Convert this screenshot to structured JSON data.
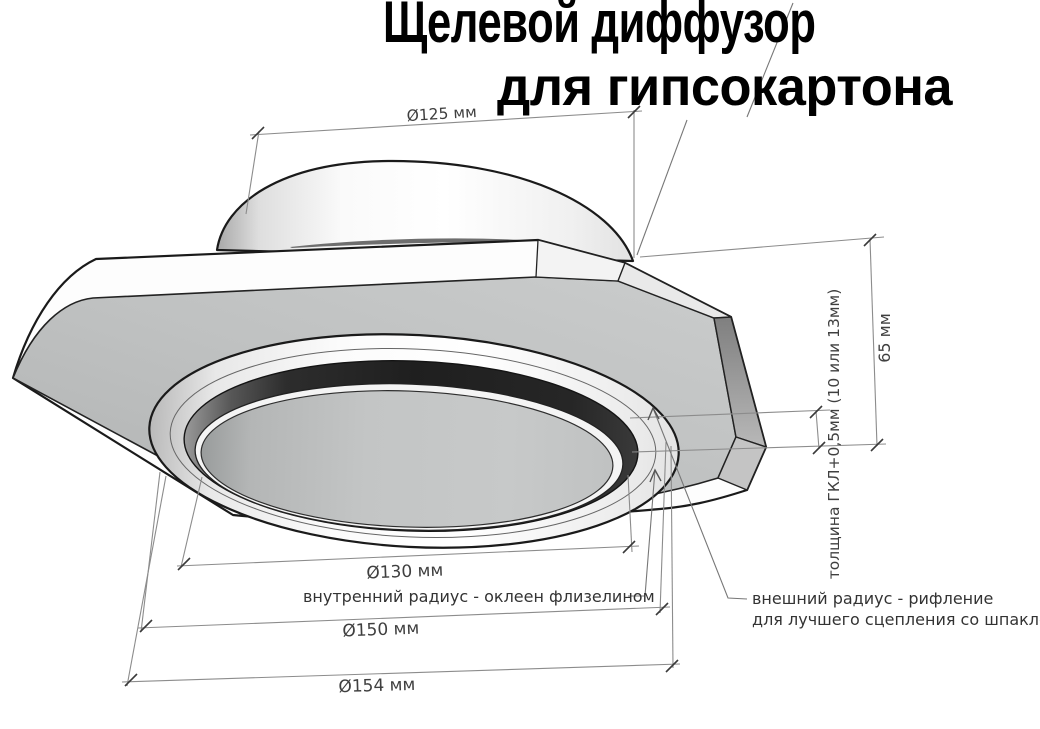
{
  "title": {
    "line1": "Щелевой диффузор",
    "line2": "для гипсокартона"
  },
  "dimensions": {
    "top_diameter": {
      "label": "Ø125 мм"
    },
    "height": {
      "label": "65 мм"
    },
    "board_thickness": {
      "label": "толщина ГКЛ+0,5мм (10 или 13мм)"
    },
    "inner_diameter": {
      "label": "Ø130 мм"
    },
    "middle_diameter": {
      "label": "Ø150 мм"
    },
    "outer_diameter": {
      "label": "Ø154 мм"
    }
  },
  "callouts": {
    "inner_radius": {
      "label": "внутренний радиус - оклеен флизелином"
    },
    "outer_radius": {
      "line1": "внешний радиус - рифление",
      "line2": "для лучшего сцепления со шпаклёвкой"
    }
  },
  "colors": {
    "background": "#ffffff",
    "outline": "#1a1a1a",
    "dimension_line": "#8c8c8c",
    "tick": "#3a3a3a",
    "dimension_text": "#3f3f3f",
    "plate_face": "#bfc1c1",
    "groove": "#232323"
  }
}
